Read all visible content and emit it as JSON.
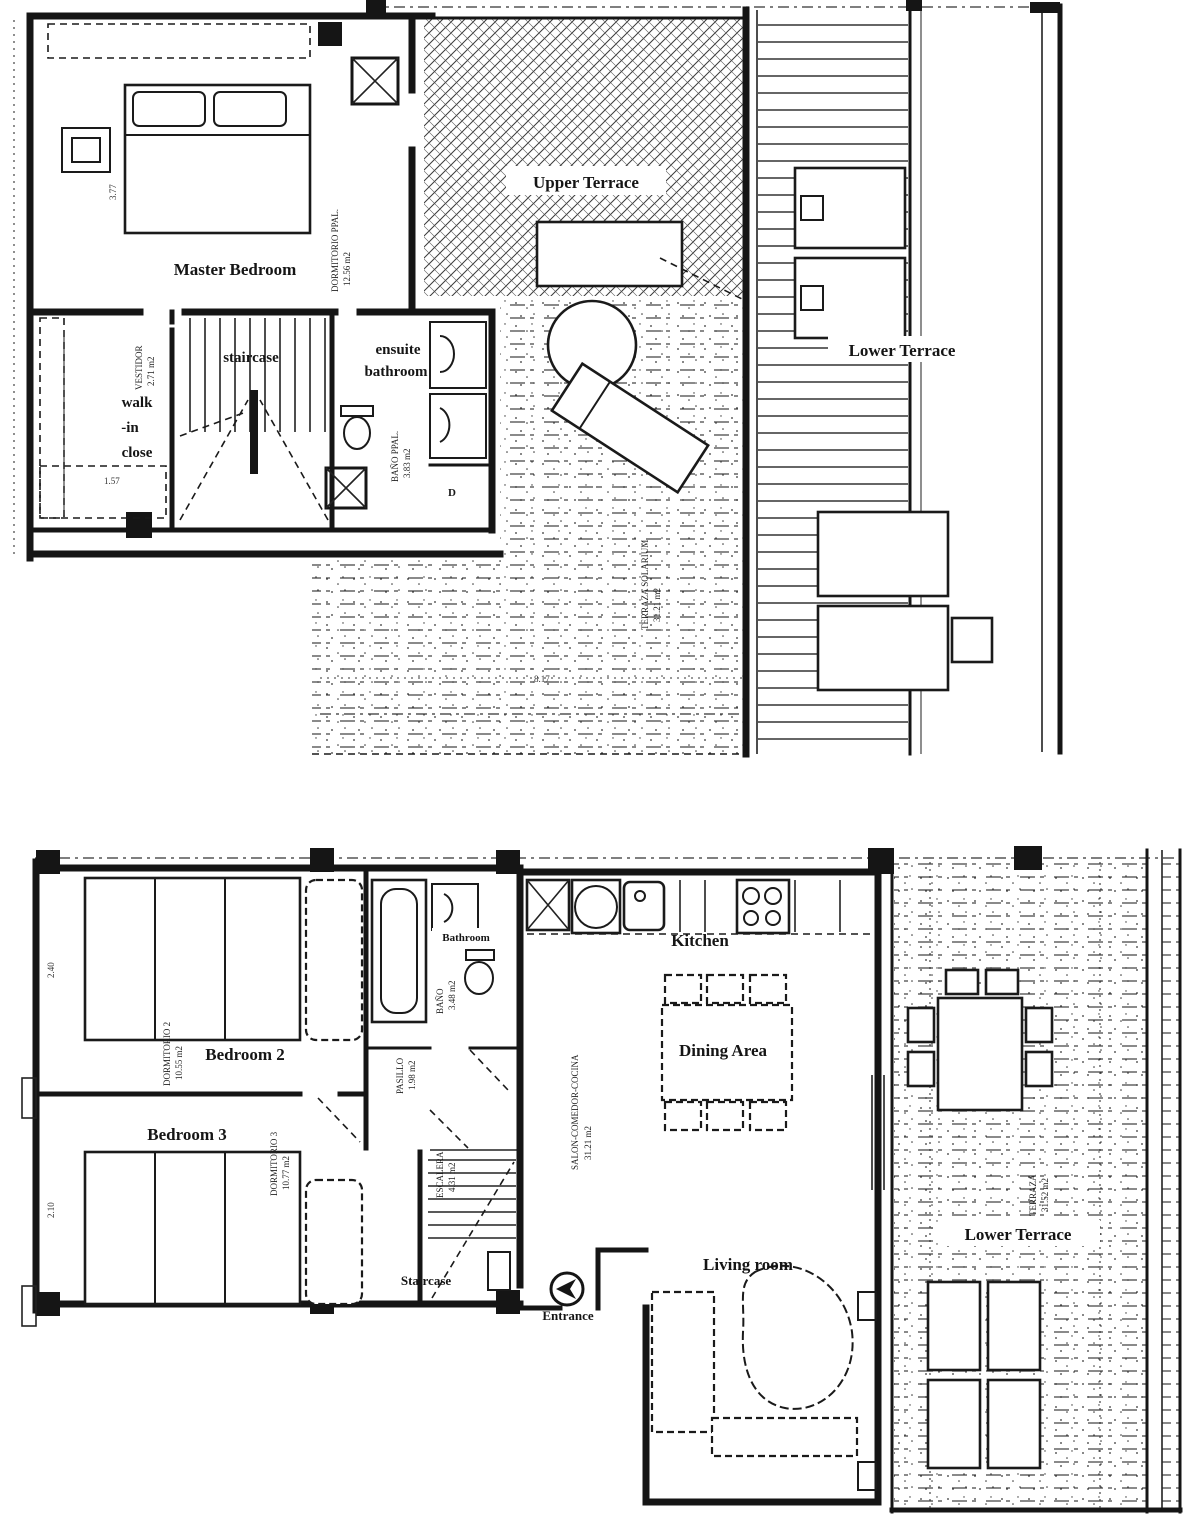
{
  "colors": {
    "ink": "#151515",
    "paper": "#ffffff"
  },
  "upper_floor": {
    "rooms": {
      "master_bedroom": "Master Bedroom",
      "staircase": "staircase",
      "ensuite_bathroom": [
        "ensuite",
        "bathroom"
      ],
      "walk_in_close": [
        "walk",
        "-in",
        "close"
      ],
      "upper_terrace": "Upper Terrace",
      "lower_terrace": "Lower Terrace"
    },
    "annotations": {
      "master_name": "DORMITORIO PPAL.",
      "master_area": "12.56 m2",
      "ensuite_name": "BAÑO PPAL.",
      "ensuite_area": "3.83 m2",
      "walkin_name": "VESTIDOR",
      "walkin_area": "2.71 m2",
      "solarium_name": "TERRAZA SOLARIUM",
      "solarium_area": "31.21 m2",
      "shower_mark": "D"
    },
    "dimensions": [
      "3.77",
      "1.57",
      "8.17"
    ]
  },
  "lower_floor": {
    "rooms": {
      "bedroom2": "Bedroom 2",
      "bedroom3": "Bedroom 3",
      "bathroom": "Bathroom",
      "kitchen": "Kitchen",
      "dining_area": "Dining Area",
      "living_room": "Living room",
      "staircase": "Staircase",
      "entrance": "Entrance",
      "lower_terrace": "Lower Terrace"
    },
    "annotations": {
      "bedroom2_name": "DORMITORIO 2",
      "bedroom2_area": "10.55 m2",
      "bedroom3_name": "DORMITORIO 3",
      "bedroom3_area": "10.77 m2",
      "bathroom_name": "BAÑO",
      "bathroom_area": "3.48 m2",
      "hall_name": "PASILLO",
      "hall_area": "1.98 m2",
      "stairs_name": "ESCALERA",
      "stairs_area": "4.31 m2",
      "salon_name": "SALON-COMEDOR-COCINA",
      "salon_area": "31.21 m2",
      "terrace_name": "TERRAZA",
      "terrace_area": "31.52 m2"
    },
    "dimensions": [
      "2.40",
      "2.10"
    ]
  }
}
